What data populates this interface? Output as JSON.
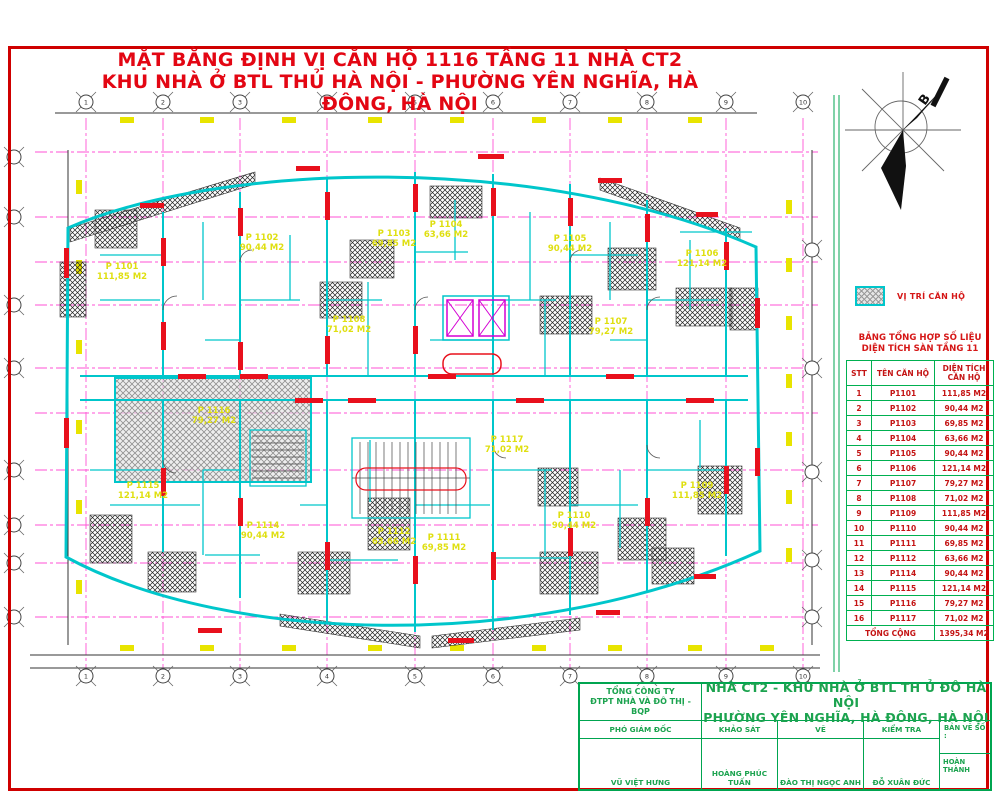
{
  "title": {
    "line1": "MẶT BẰNG ĐỊNH VỊ CĂN HỘ 1116 TẦNG 11 NHÀ CT2",
    "line2": "KHU NHÀ Ở BTL THỦ HÀ NỘI - PHƯỜNG YÊN NGHĨA, HÀ ĐÔNG, HÀ NỘI"
  },
  "north_arrow": {
    "label": "B"
  },
  "legend": {
    "label": "VỊ TRÍ CĂN HỘ"
  },
  "summary_table": {
    "title_line1": "BẢNG TỔNG HỢP SỐ LIỆU",
    "title_line2": "DIỆN TÍCH SÀN TẦNG 11",
    "headers": [
      "STT",
      "TÊN CĂN HỘ",
      "DIỆN TÍCH CĂN HỘ"
    ],
    "rows": [
      [
        "1",
        "P1101",
        "111,85 M2"
      ],
      [
        "2",
        "P1102",
        "90,44 M2"
      ],
      [
        "3",
        "P1103",
        "69,85 M2"
      ],
      [
        "4",
        "P1104",
        "63,66 M2"
      ],
      [
        "5",
        "P1105",
        "90,44 M2"
      ],
      [
        "6",
        "P1106",
        "121,14 M2"
      ],
      [
        "7",
        "P1107",
        "79,27 M2"
      ],
      [
        "8",
        "P1108",
        "71,02 M2"
      ],
      [
        "9",
        "P1109",
        "111,85 M2"
      ],
      [
        "10",
        "P1110",
        "90,44 M2"
      ],
      [
        "11",
        "P1111",
        "69,85 M2"
      ],
      [
        "12",
        "P1112",
        "63,66 M2"
      ],
      [
        "13",
        "P1114",
        "90,44 M2"
      ],
      [
        "14",
        "P1115",
        "121,14 M2"
      ],
      [
        "15",
        "P1116",
        "79,27 M2"
      ],
      [
        "16",
        "P1117",
        "71,02 M2"
      ]
    ],
    "total_label": "TỔNG CỘNG",
    "total_value": "1395,34 M2"
  },
  "title_block": {
    "company_line1": "TỔNG CÔNG TY",
    "company_line2": "ĐTPT NHÀ VÀ ĐÔ THỊ - BQP",
    "project_line1": "NHÀ CT2 - KHU NHÀ Ở BTL TH Ủ ĐÔ HÀ NỘI",
    "project_line2": "PHƯỜNG YÊN NGHĨA, HÀ ĐÔNG, HÀ NỘI",
    "roles": [
      "PHÓ GIÁM ĐỐC",
      "KHẢO SÁT",
      "VẼ",
      "KIỂM TRA"
    ],
    "names": [
      "VŨ VIỆT HƯNG",
      "HOÀNG PHÚC TUẤN",
      "ĐÀO THỊ NGỌC ANH",
      "ĐỖ XUÂN ĐỨC"
    ],
    "sheet_label": "BẢN VẼ SỐ :",
    "status": "HOÀN THÀNH"
  },
  "plan": {
    "apartments": [
      {
        "name": "P 1101",
        "area": "111,85 M2",
        "x": 122,
        "y": 272
      },
      {
        "name": "P 1102",
        "area": "90,44 M2",
        "x": 262,
        "y": 243
      },
      {
        "name": "P 1103",
        "area": "69,85 M2",
        "x": 394,
        "y": 239
      },
      {
        "name": "P 1104",
        "area": "63,66 M2",
        "x": 446,
        "y": 230
      },
      {
        "name": "P 1105",
        "area": "90,44 M2",
        "x": 570,
        "y": 244
      },
      {
        "name": "P 1106",
        "area": "121,14 M2",
        "x": 702,
        "y": 259
      },
      {
        "name": "P 1108",
        "area": "71,02 M2",
        "x": 349,
        "y": 325
      },
      {
        "name": "P 1107",
        "area": "79,27 M2",
        "x": 611,
        "y": 327
      },
      {
        "name": "P 1117",
        "area": "71,02 M2",
        "x": 507,
        "y": 445
      },
      {
        "name": "P 1109",
        "area": "111,85 M2",
        "x": 697,
        "y": 491
      },
      {
        "name": "P 1116",
        "area": "79,27 M2",
        "x": 214,
        "y": 416,
        "highlight": true
      },
      {
        "name": "P 1115",
        "area": "121,14 M2",
        "x": 143,
        "y": 491
      },
      {
        "name": "P 1114",
        "area": "90,44 M2",
        "x": 263,
        "y": 531
      },
      {
        "name": "P 1112",
        "area": "63,66 M2",
        "x": 394,
        "y": 537
      },
      {
        "name": "P 1111",
        "area": "69,85 M2",
        "x": 444,
        "y": 543
      },
      {
        "name": "P 1110",
        "area": "90,44 M2",
        "x": 574,
        "y": 521
      }
    ],
    "axes": {
      "top": {
        "y": 102,
        "xs": [
          86,
          163,
          240,
          327,
          415,
          493,
          570,
          647,
          726,
          803
        ],
        "labels": [
          "1",
          "2",
          "3",
          "4",
          "5",
          "6",
          "7",
          "8",
          "9",
          "10"
        ]
      },
      "bottom": {
        "y": 676,
        "xs": [
          86,
          163,
          240,
          327,
          415,
          493,
          570,
          647,
          726,
          803
        ],
        "labels": [
          "1",
          "2",
          "3",
          "4",
          "5",
          "6",
          "7",
          "8",
          "9",
          "10"
        ]
      },
      "left": {
        "x": 14,
        "ys": [
          157,
          217,
          305,
          368,
          470,
          525,
          563,
          617
        ],
        "labels": [
          "",
          "",
          "",
          "",
          "",
          "",
          "",
          ""
        ]
      },
      "right": {
        "x": 812,
        "ys": [
          250,
          368,
          472,
          560,
          617
        ],
        "labels": [
          "",
          "",
          "",
          "",
          ""
        ]
      }
    }
  },
  "colors": {
    "title_red": "#e30613",
    "wall_cyan": "#00c6cb",
    "grid_magenta": "#ff35cf",
    "shear_red": "#e8101c",
    "frame_green": "#00a550",
    "label_yellow": "#dfdf10",
    "table_text_red": "#c41414"
  }
}
